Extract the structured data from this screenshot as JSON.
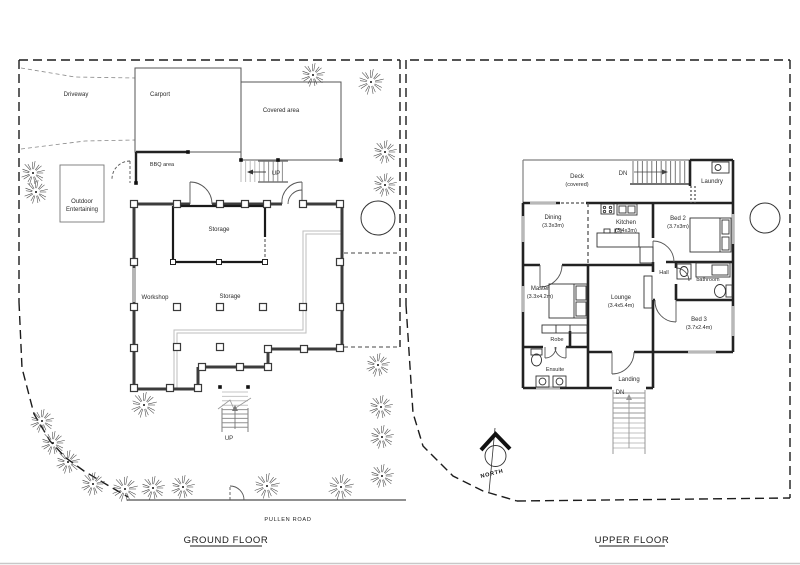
{
  "ground": {
    "title": "GROUND FLOOR",
    "road": "PULLEN ROAD",
    "driveway": "Driveway",
    "carport": "Carport",
    "covered": "Covered area",
    "bbq": "BBQ area",
    "outdoor1": "Outdoor",
    "outdoor2": "Entertaining",
    "storage_room": "Storage",
    "storage": "Storage",
    "workshop": "Workshop",
    "up_top": "UP",
    "up_bottom": "UP"
  },
  "upper": {
    "title": "UPPER FLOOR",
    "north": "NORTH",
    "deck1": "Deck",
    "deck2": "(covered)",
    "dn_top": "DN",
    "dn_bottom": "DN",
    "laundry": "Laundry",
    "dining": "Dining",
    "dining_size": "(3.3x3m)",
    "kitchen": "Kitchen",
    "kitchen_size": "(3.4x3m)",
    "bed2": "Bed 2",
    "bed2_size": "(3.7x3m)",
    "hall": "Hall",
    "bathroom": "bathroom",
    "master": "Master",
    "master_size": "(3.3x4.2m)",
    "lounge": "Lounge",
    "lounge_size": "(3.4x5.4m)",
    "bed3": "Bed 3",
    "bed3_size": "(3.7x2.4m)",
    "robe": "Robe",
    "ensuite": "Ensuite",
    "landing": "Landing"
  }
}
